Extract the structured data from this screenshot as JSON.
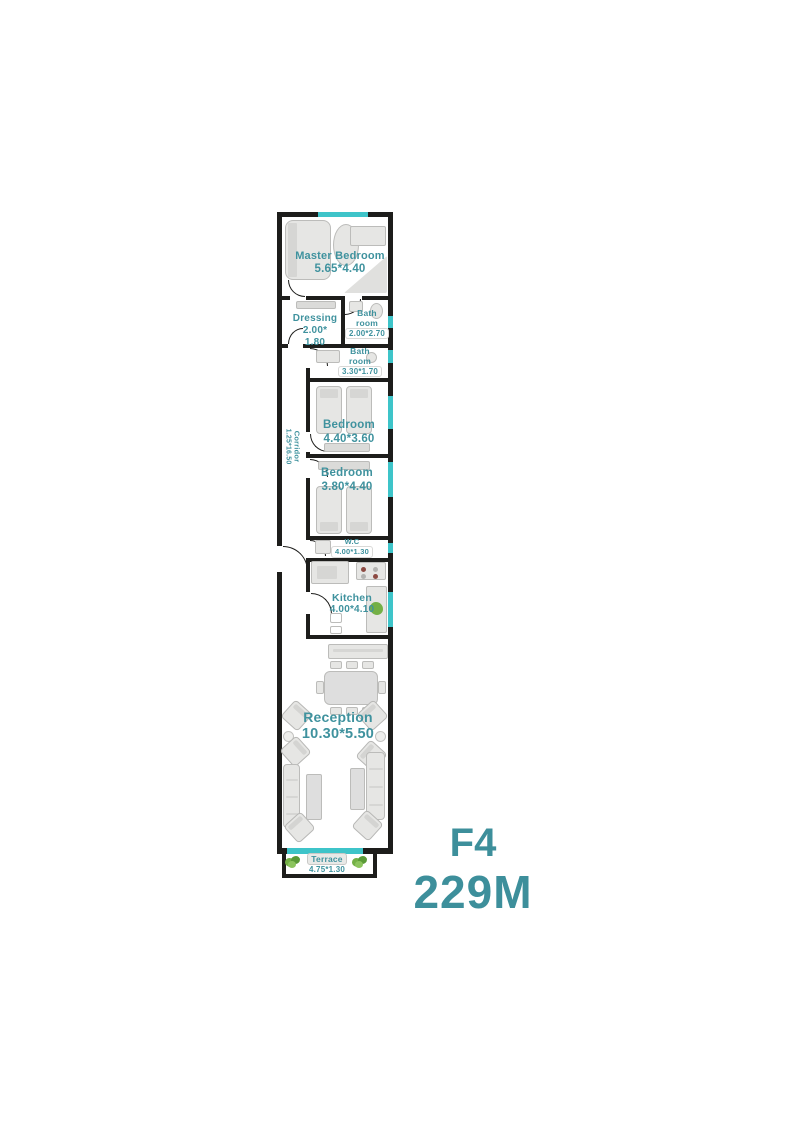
{
  "title": {
    "code": "F4",
    "area": "229M"
  },
  "colors": {
    "wall": "#1d1d1b",
    "window_cyan": "#3ec4c9",
    "label_teal": "#3f929e",
    "title_teal": "#3d8f9b",
    "furniture_gray": "#e6e6e4",
    "plant_green": "#74b046"
  },
  "rooms": {
    "master_bedroom": {
      "name": "Master Bedroom",
      "dims": "5.65*4.40"
    },
    "dressing": {
      "name": "Dressing",
      "dims_line1": "2.00*",
      "dims_line2": "1.80"
    },
    "bathroom_top": {
      "name_line1": "Bath",
      "name_line2": "room",
      "dims": "2.00*2.70"
    },
    "bathroom_mid": {
      "name_line1": "Bath",
      "name_line2": "room",
      "dims": "3.30*1.70"
    },
    "corridor": {
      "name": "Corridor",
      "dims": "1.25*16.50"
    },
    "bedroom_first": {
      "name": "Bedroom",
      "dims": "4.40*3.60"
    },
    "bedroom_second": {
      "name": "Bedroom",
      "dims": "3.80*4.40"
    },
    "wc": {
      "name": "W.C",
      "dims": "4.00*1.30"
    },
    "kitchen": {
      "name": "Kitchen",
      "dims": "4.00*4.10"
    },
    "reception": {
      "name": "Reception",
      "dims": "10.30*5.50"
    },
    "terrace": {
      "name": "Terrace",
      "dims": "4.75*1.30"
    }
  }
}
